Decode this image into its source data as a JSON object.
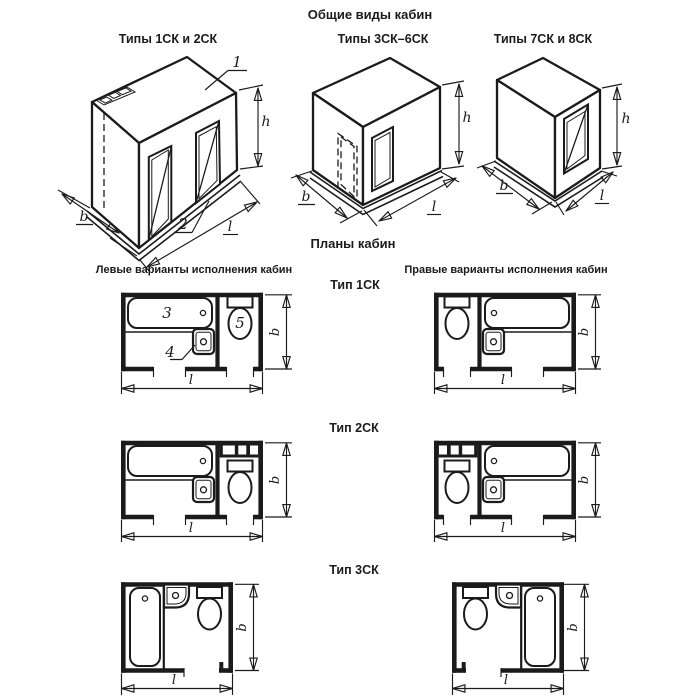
{
  "colors": {
    "ink": "#1b1b1b",
    "paper": "#ffffff"
  },
  "titles": {
    "general_views": "Общие виды кабин",
    "plans": "Планы кабин",
    "left_variants": "Левые варианты исполнения кабин",
    "right_variants": "Правые варианты исполнения кабин"
  },
  "iso_views": [
    {
      "title": "Типы 1СК и 2СК"
    },
    {
      "title": "Типы 3СК–6СК"
    },
    {
      "title": "Типы 7СК и 8СК"
    }
  ],
  "plan_rows": [
    {
      "title": "Тип 1СК"
    },
    {
      "title": "Тип 2СК"
    },
    {
      "title": "Тип 3СК"
    }
  ],
  "dims": {
    "h": "h",
    "b": "b",
    "l": "l"
  },
  "callouts": {
    "roof_panel": "1",
    "floor_panel": "2",
    "bathtub": "3",
    "washbasin": "4",
    "toilet": "5"
  }
}
